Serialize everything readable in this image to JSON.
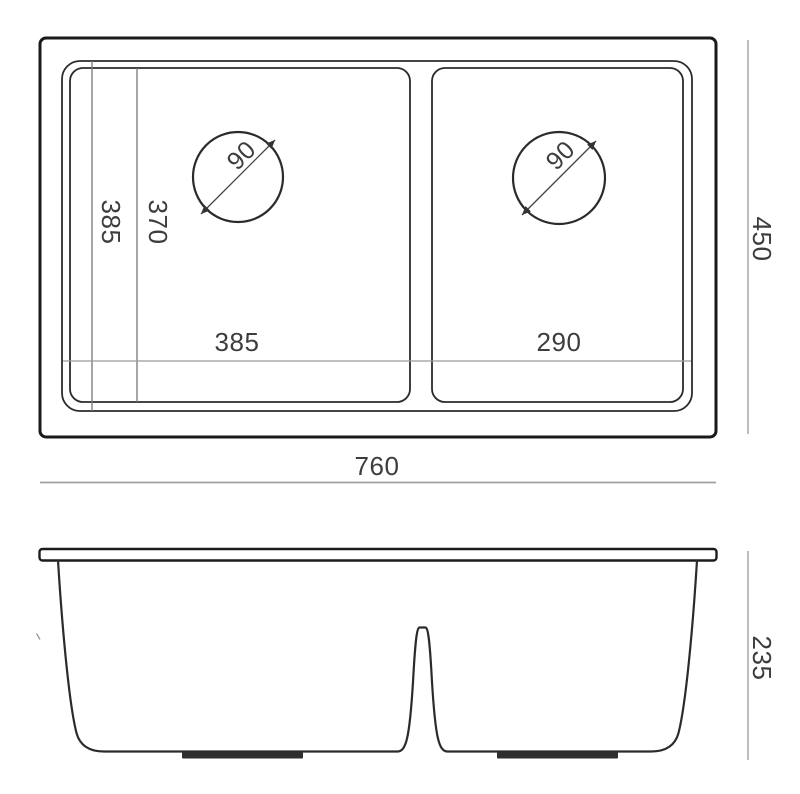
{
  "drawing": {
    "type": "technical-dimension-drawing",
    "subject": "double bowl undermount kitchen sink",
    "views": {
      "top_view": {
        "overall_width": "760",
        "overall_depth": "450",
        "rim_depth": "385",
        "bowl_depth": "370",
        "left_bowl_width": "385",
        "right_bowl_width": "290",
        "left_drain_diameter": "90",
        "right_drain_diameter": "90"
      },
      "front_view": {
        "height": "235"
      }
    },
    "colors": {
      "background": "#ffffff",
      "outline": "#1a1a1a",
      "thin_outline": "#2b2b2b",
      "dimension_line": "#9a9a9a",
      "label_text": "#3d3d3d"
    }
  }
}
